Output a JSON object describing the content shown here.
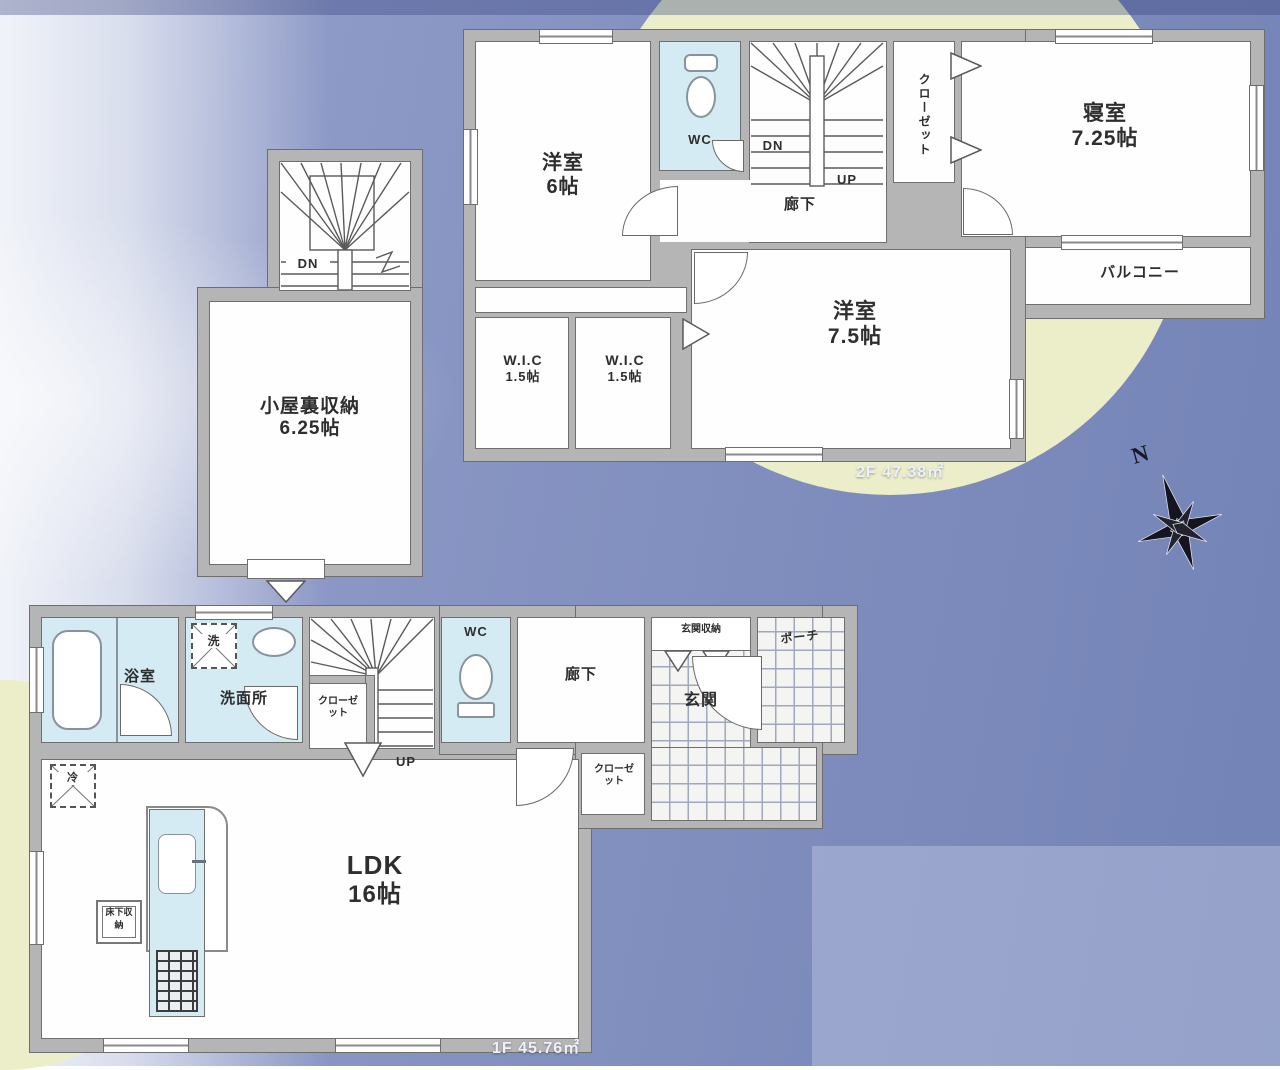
{
  "colors": {
    "wall": "#b5b5b5",
    "wet_room": "#d4ebf3",
    "accent_circle": "#eceec9",
    "background": "#8290bf"
  },
  "compass": {
    "label": "N"
  },
  "floor2": {
    "area_label": "2F 47.38㎡",
    "rooms": {
      "western6": {
        "name": "洋室",
        "size": "6帖"
      },
      "wc": {
        "name": "WC"
      },
      "hallway": {
        "name": "廊下"
      },
      "stairs_down": {
        "name": "DN"
      },
      "stairs_up": {
        "name": "UP"
      },
      "closet": {
        "name": "クローゼット"
      },
      "bedroom": {
        "name": "寝室",
        "size": "7.25帖"
      },
      "balcony": {
        "name": "バルコニー"
      },
      "western75": {
        "name": "洋室",
        "size": "7.5帖"
      },
      "wic_left": {
        "name": "W.I.C",
        "size": "1.5帖"
      },
      "wic_right": {
        "name": "W.I.C",
        "size": "1.5帖"
      }
    }
  },
  "attic": {
    "stairs_down": {
      "name": "DN"
    },
    "storage": {
      "name": "小屋裏収納",
      "size": "6.25帖"
    }
  },
  "floor1": {
    "area_label": "1F 45.76㎡",
    "rooms": {
      "bathroom": {
        "name": "浴室"
      },
      "washroom": {
        "name": "洗面所"
      },
      "washer": {
        "name": "洗"
      },
      "stair_closet": {
        "name": "クローゼット"
      },
      "stairs_up": {
        "name": "UP"
      },
      "wc": {
        "name": "WC"
      },
      "hallway": {
        "name": "廊下"
      },
      "entrance_storage": {
        "name": "玄関収納"
      },
      "entrance": {
        "name": "玄関"
      },
      "porch": {
        "name": "ポーチ"
      },
      "hall_closet": {
        "name": "クローゼット"
      },
      "ldk": {
        "name": "LDK",
        "size": "16帖"
      },
      "refrigerator": {
        "name": "冷"
      },
      "floor_storage": {
        "name": "床下収納"
      }
    }
  }
}
